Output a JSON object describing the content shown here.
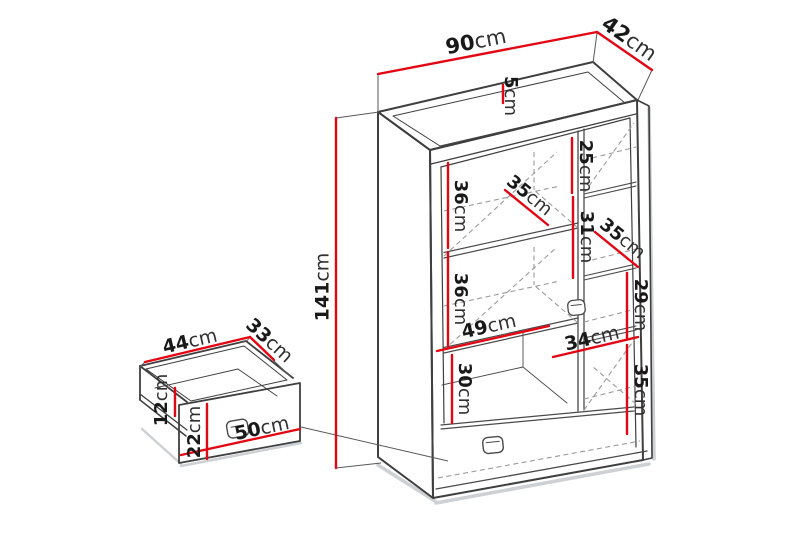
{
  "diagram": {
    "type": "furniture-dimension-diagram",
    "subject": "cabinet with shelves and drawers, exploded drawer detail",
    "unit": "cm",
    "colors": {
      "dimension_red": "#e30613",
      "line_dark": "#3f3f3f",
      "line_dashed": "#9b9b9b",
      "shadow_gray": "#cdd1d4",
      "text": "#191919",
      "background": "#ffffff"
    },
    "cabinet": {
      "overall": {
        "width": {
          "value": "90",
          "unit": "cm"
        },
        "depth": {
          "value": "42",
          "unit": "cm"
        },
        "height": {
          "value": "141",
          "unit": "cm"
        },
        "top_rim": {
          "value": "5",
          "unit": "cm"
        }
      },
      "left_column": {
        "width": {
          "value": "49",
          "unit": "cm"
        },
        "shelf_depth": {
          "value": "35",
          "unit": "cm"
        },
        "sections": [
          {
            "value": "36",
            "unit": "cm"
          },
          {
            "value": "36",
            "unit": "cm"
          },
          {
            "value": "30",
            "unit": "cm"
          }
        ]
      },
      "right_column": {
        "width": {
          "value": "34",
          "unit": "cm"
        },
        "shelf_depth": {
          "value": "35",
          "unit": "cm"
        },
        "sections": [
          {
            "value": "25",
            "unit": "cm"
          },
          {
            "value": "31",
            "unit": "cm"
          },
          {
            "value": "29",
            "unit": "cm"
          },
          {
            "value": "35",
            "unit": "cm"
          }
        ]
      }
    },
    "drawer": {
      "width": {
        "value": "44",
        "unit": "cm"
      },
      "depth": {
        "value": "33",
        "unit": "cm"
      },
      "side_height": {
        "value": "12",
        "unit": "cm"
      },
      "front_height": {
        "value": "22",
        "unit": "cm"
      },
      "front_width": {
        "value": "50",
        "unit": "cm"
      }
    }
  }
}
